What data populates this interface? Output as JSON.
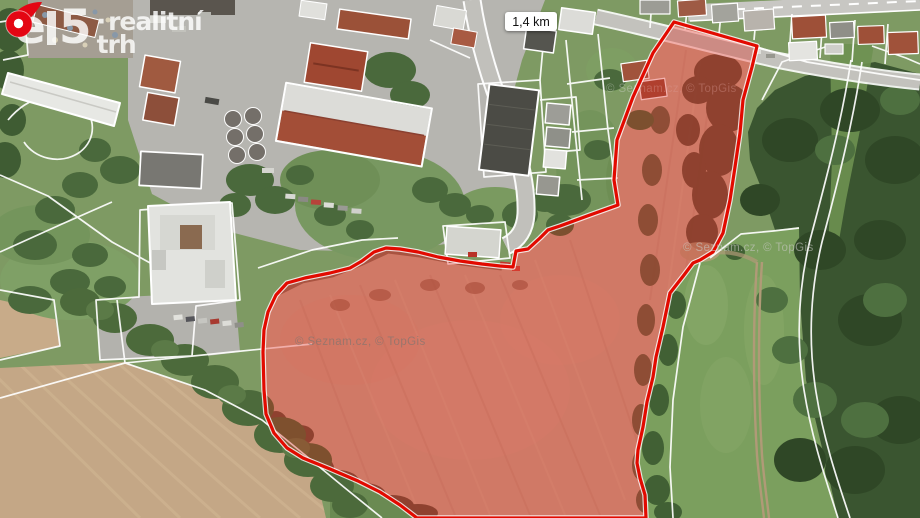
{
  "brand": {
    "e": "e",
    "five": "5",
    "dot": "·",
    "line1": "realitní",
    "line2": "trh"
  },
  "distance_badge": {
    "text": "1,4 km"
  },
  "watermarks": {
    "left": "© Seznam.cz, © TopGis",
    "right": "© Seznam.cz, © TopGis",
    "top": "© Seznam.cz, © TopGis"
  },
  "map": {
    "type": "aerial-satellite",
    "highlight": {
      "outline_color": "#e20a00",
      "fill_color": "rgba(222,32,22,0.34)",
      "boundary_line_color": "#ffffff"
    },
    "pin_color": "#e40613"
  }
}
